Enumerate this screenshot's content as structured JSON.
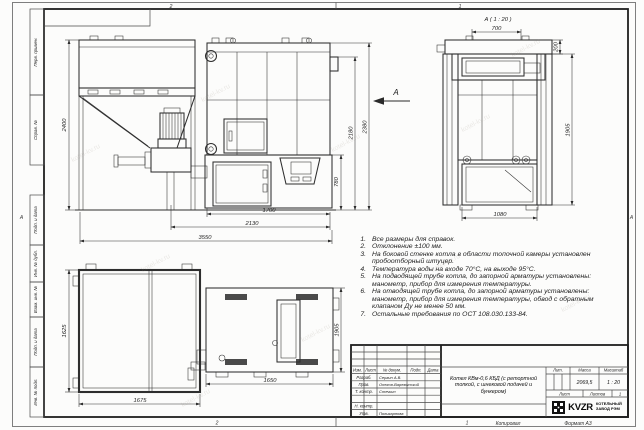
{
  "watermark": "kotel-kv.ru",
  "frame": {
    "margin_labels": {
      "perv": "Перв. примен.",
      "sprav": "Справ. №",
      "podp1": "Подп. и дата",
      "inv_dubl": "Инв. № дубл.",
      "vzam": "Взам. инв. №",
      "podp2": "Подп. и дата",
      "inv_podl": "Инв. № подл."
    },
    "zones": {
      "top_left": "2",
      "top_right": "1",
      "bottom_left": "2",
      "bottom_right": "1",
      "left": "А",
      "right": "А"
    },
    "footer": {
      "copied": "Копировал",
      "format": "Формат А3"
    }
  },
  "views": {
    "arrow_label": "А",
    "detail_title": "А ( 1 : 20 )",
    "front_dims": {
      "bunker_height": "2400",
      "furnace_height": "780",
      "body_height": "2180",
      "total_height": "2380",
      "furnace_width": "1700",
      "boiler_width": "2130",
      "total_width": "3550"
    },
    "detail_dims": {
      "top_width": "700",
      "collar_height": "200",
      "body_height": "1905",
      "bottom_width": "1080"
    },
    "plan_dims": {
      "bunker_depth": "1625",
      "bunker_width": "1675",
      "boiler_width": "1650",
      "boiler_depth": "1905"
    }
  },
  "notes": {
    "items": [
      {
        "n": "1.",
        "text": "Все размеры для справок."
      },
      {
        "n": "2.",
        "text": "Отклонение ±100 мм."
      },
      {
        "n": "3.",
        "text": "На боковой стенке котла в области топочной камеры установлен пробоотборный штуцер."
      },
      {
        "n": "4.",
        "text": "Температура воды на входе 70°С, на выходе 95°С."
      },
      {
        "n": "5.",
        "text": "На подводящей трубе котла, до запорной арматуры установлены: манометр, прибор для измерения температуры."
      },
      {
        "n": "6.",
        "text": "На отводящей трубе котла, до запорной арматуры установлены: манометр, прибор для измерения температуры, обвод с обратным клапаном Ду не менее 50 мм."
      },
      {
        "n": "7.",
        "text": "Остальные требования по ОСТ 108.030.133-84."
      }
    ]
  },
  "title_block": {
    "header": {
      "izm": "Изм.",
      "list": "Лист",
      "doc": "№ докум.",
      "podp": "Подп.",
      "data": "Дата"
    },
    "rows": [
      {
        "role": "Разраб.",
        "name": "Сергин А.В."
      },
      {
        "role": "Пров.",
        "name": "Онегов-Варежинский"
      },
      {
        "role": "Т. контр.",
        "name": "Стечкин"
      },
      {
        "role": "",
        "name": ""
      },
      {
        "role": "Н. контр.",
        "name": ""
      },
      {
        "role": "Утв.",
        "name": "Поликарпова"
      }
    ],
    "title": "Котел КВм-0,6 КБД (с ретортной топкой, с шнековой подачей и бункером)",
    "lit_label": "Лит.",
    "mass_label": "Масса",
    "scale_label": "Масштаб",
    "mass": "2069,5",
    "scale": "1 : 20",
    "sheet_label": "Лист",
    "sheets_label": "Листов",
    "sheets_value": "1",
    "company": {
      "logo": "KVZR",
      "line1": "КОТЕЛЬНЫЙ",
      "line2": "ЗАВОД РЭМ"
    }
  }
}
